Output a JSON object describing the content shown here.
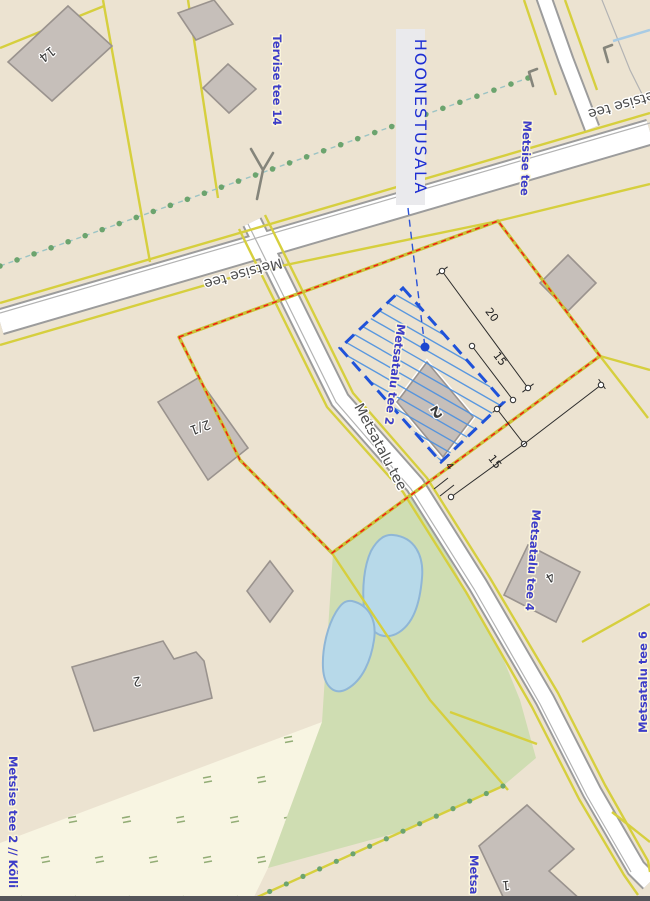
{
  "map": {
    "title_label": "HOONESTUSALA",
    "roads": {
      "metsise_tee_label_left": "Metsise tee",
      "metsise_tee_label_right": "Metsise tee",
      "metsatalu_tee_label": "Metsatalu tee"
    },
    "addresses": {
      "tervise_tee_14": "Tervise tee 14",
      "metsise_tee": "Metsise tee",
      "metsatalu_tee_2": "Metsatalu tee 2",
      "metsatalu_tee_4": "Metsatalu tee 4",
      "metsatalu_tee_6": "Metsatalu tee 6",
      "metsise_tee_2_kolli": "Metsise tee 2 // Kõlli",
      "metsa_partial": "Metsa"
    },
    "buildings": {
      "b14": "14",
      "b2_1": "2/1",
      "b2_center": "2",
      "b2_west": "2",
      "b4": "4",
      "b1": "1"
    },
    "dimensions": {
      "d20": "20",
      "d15_upper": "15",
      "d15_lower": "15",
      "d4": "4"
    },
    "colors": {
      "land": "#ece3d1",
      "meadow": "#f8f5e2",
      "greenfield": "#cfddb2",
      "water": "#b7d9e9",
      "parcel_line": "#d6cf3e",
      "boundary_red": "#f31b12",
      "building_area_blue": "#1f52d9",
      "address_label_blue": "#3d3dc8",
      "road_label_gray": "#4a4a4a"
    }
  }
}
